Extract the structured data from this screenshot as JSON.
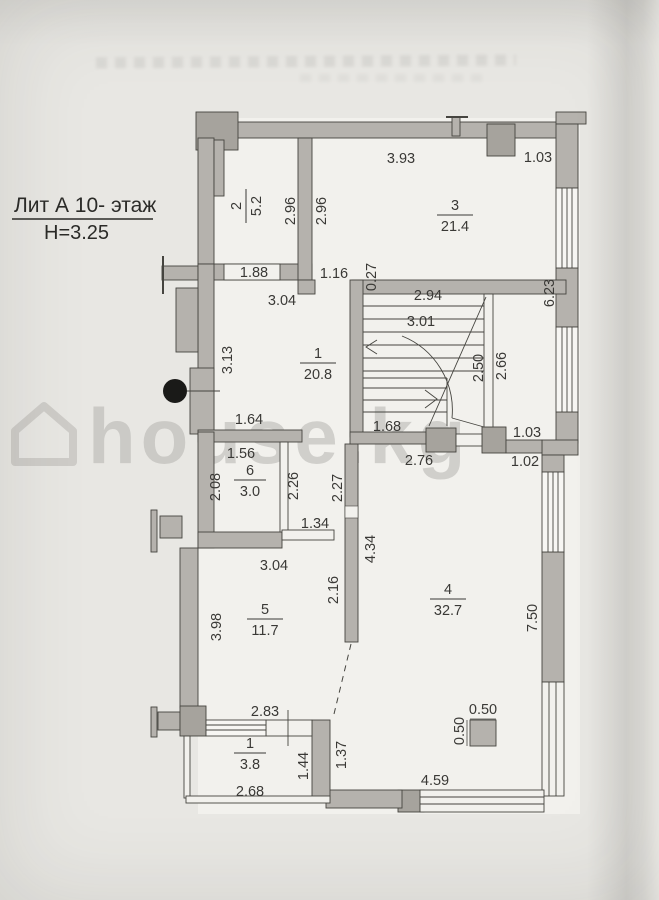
{
  "title": {
    "line1": "Лит А 10- этаж",
    "line2": "Н=3.25"
  },
  "watermark": {
    "brand": "house.kg"
  },
  "rooms": {
    "hall": {
      "num": "1",
      "area": "20.8"
    },
    "room2": {
      "num": "2",
      "area": "5.2"
    },
    "room3": {
      "num": "3",
      "area": "21.4"
    },
    "room4": {
      "num": "4",
      "area": "32.7"
    },
    "room5": {
      "num": "5",
      "area": "11.7"
    },
    "room6": {
      "num": "6",
      "area": "3.0"
    },
    "balcony": {
      "num": "1",
      "area": "3.8"
    }
  },
  "dims": {
    "r3_top_a": "3.93",
    "r3_top_b": "1.03",
    "r2_right": "2.96",
    "r3_left": "2.96",
    "r2_bottom": "1.88",
    "hall_door": "1.16",
    "stair_stub": "0.27",
    "hall_top": "3.04",
    "stair_width": "2.94",
    "stair_depth": "3.01",
    "right_wall_upper": "6.23",
    "hall_left": "3.13",
    "stair_right_inner": "2.50",
    "stair_right_outer": "2.66",
    "hall_bottom": "1.64",
    "stair_bottom": "1.68",
    "r4_top_door": "1.03",
    "r6_top": "1.56",
    "r4_top": "2.76",
    "r4_top_right": "1.02",
    "r6_left": "2.08",
    "r6_right": "2.26",
    "corridor_right": "2.27",
    "corridor_door": "1.34",
    "r5_top": "3.04",
    "r4_left_upper": "4.34",
    "r5_right": "2.16",
    "r5_left": "3.98",
    "r4_right": "7.50",
    "balcony_top": "2.83",
    "column_width": "0.50",
    "column_height": "0.50",
    "r4_bottom_left": "1.37",
    "balcony_right": "1.44",
    "r4_bottom": "4.59",
    "balcony_bottom": "2.68"
  }
}
